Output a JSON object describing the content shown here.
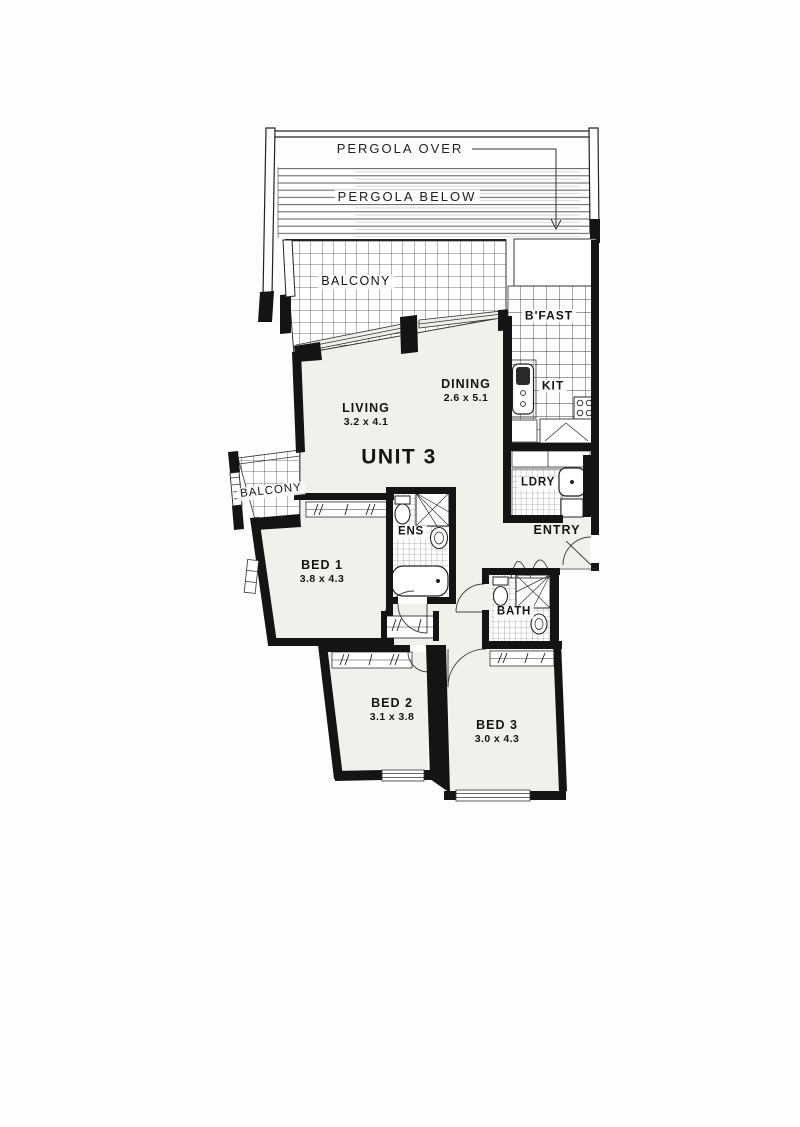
{
  "plan": {
    "unit_label": "UNIT 3",
    "pergola": {
      "over": "PERGOLA OVER",
      "below": "PERGOLA BELOW"
    },
    "rooms": {
      "balcony_main": {
        "label": "BALCONY"
      },
      "balcony_side": {
        "label": "BALCONY"
      },
      "breakfast": {
        "label": "B'FAST"
      },
      "kitchen": {
        "label": "KIT"
      },
      "dining": {
        "label": "DINING",
        "dimensions": "2.6 x 5.1"
      },
      "living": {
        "label": "LIVING",
        "dimensions": "3.2 x 4.1"
      },
      "laundry": {
        "label": "LDRY"
      },
      "ensuite": {
        "label": "ENS"
      },
      "entry": {
        "label": "ENTRY"
      },
      "bed1": {
        "label": "BED 1",
        "dimensions": "3.8 x 4.3"
      },
      "bath": {
        "label": "BATH"
      },
      "bed2": {
        "label": "BED 2",
        "dimensions": "3.1 x 3.8"
      },
      "bed3": {
        "label": "BED 3",
        "dimensions": "3.0 x 4.3"
      }
    },
    "colors": {
      "wall": "#141414",
      "floor": "#f1f1ec",
      "tile_line": "#4a4a4a",
      "paper": "#fdfdfb"
    }
  }
}
